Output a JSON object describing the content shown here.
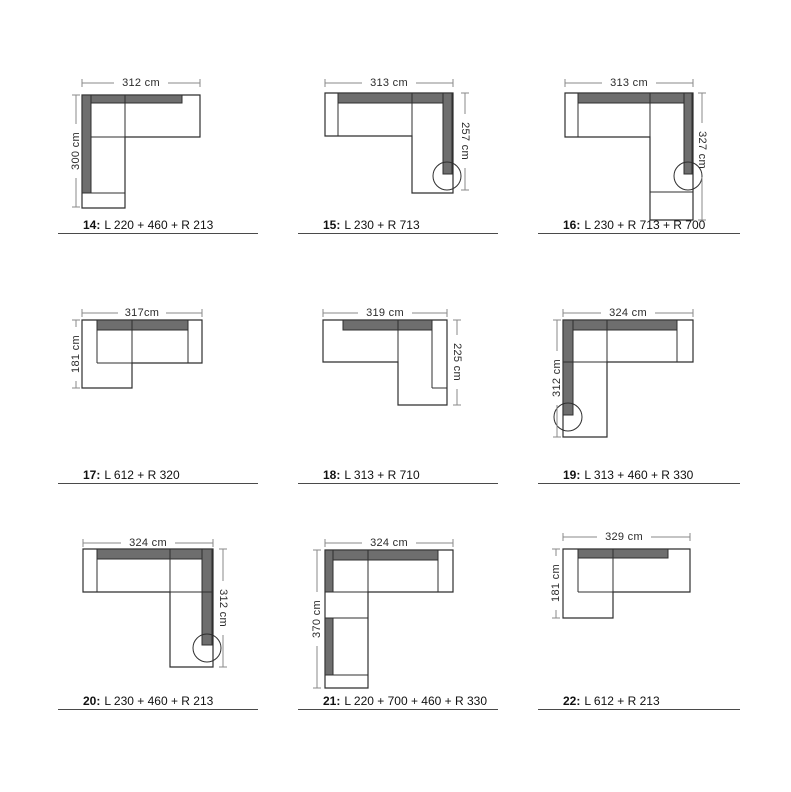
{
  "page": {
    "background": "#ffffff",
    "outline_color": "#2f2f2f",
    "backrest_fill": "#6e6e6e",
    "dimension_line_color": "#8a8a8a"
  },
  "items": [
    {
      "number_label": "14:",
      "config": "L 220 + 460 + R 213",
      "width_label": "312 cm",
      "height_label": "300 cm",
      "height_side": "left"
    },
    {
      "number_label": "15:",
      "config": "L 230 + R 713",
      "width_label": "313 cm",
      "height_label": "257 cm",
      "height_side": "right"
    },
    {
      "number_label": "16:",
      "config": "L 230 + R 713 + R 700",
      "width_label": "313 cm",
      "height_label": "327 cm",
      "height_side": "right"
    },
    {
      "number_label": "17:",
      "config": "L 612 + R 320",
      "width_label": "317cm",
      "height_label": "181 cm",
      "height_side": "left"
    },
    {
      "number_label": "18:",
      "config": "L 313 + R 710",
      "width_label": "319 cm",
      "height_label": "225 cm",
      "height_side": "right"
    },
    {
      "number_label": "19:",
      "config": "L 313 + 460 + R 330",
      "width_label": "324 cm",
      "height_label": "312 cm",
      "height_side": "left"
    },
    {
      "number_label": "20:",
      "config": "L 230 + 460 + R 213",
      "width_label": "324 cm",
      "height_label": "312 cm",
      "height_side": "right"
    },
    {
      "number_label": "21:",
      "config": "L 220 + 700 + 460 + R 330",
      "width_label": "324 cm",
      "height_label": "370 cm",
      "height_side": "left"
    },
    {
      "number_label": "22:",
      "config": "L 612 + R 213",
      "width_label": "329 cm",
      "height_label": "181 cm",
      "height_side": "left"
    }
  ]
}
